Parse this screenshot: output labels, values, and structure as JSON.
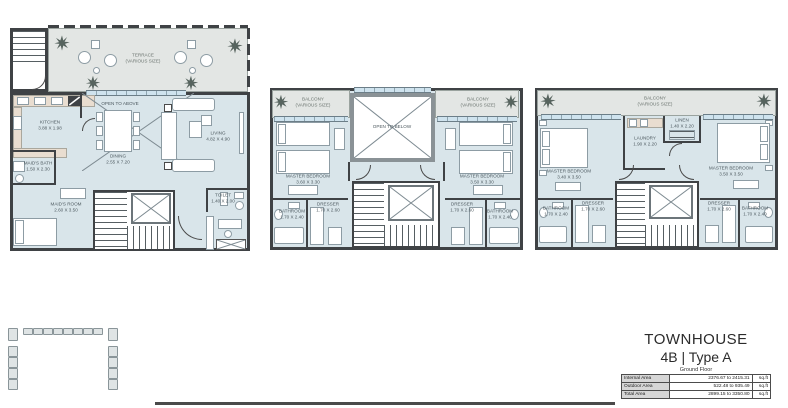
{
  "colors": {
    "wall": "#3f4245",
    "interior_floor": "#d9e5ea",
    "outdoor_floor": "#e3e6e4",
    "counter_beige": "#e9ddd0",
    "furniture_outline": "#8d9ca4",
    "plant": "#57645f",
    "glazing": "#cfe3ee",
    "line": "#4a4a4a"
  },
  "plans": {
    "ground": {
      "labels": {
        "terrace": {
          "name": "TERRACE",
          "size": "(VARIOUS SIZE)"
        },
        "kitchen": {
          "name": "KITCHEN",
          "dims": "3.88 X 1.98"
        },
        "open_above": {
          "name": "OPEN TO ABOVE"
        },
        "dining": {
          "name": "DINING",
          "dims": "2.55 X 7.20"
        },
        "living": {
          "name": "LIVING",
          "dims": "4.82 X 4.90"
        },
        "maids_bath": {
          "name": "MAID'S BATH",
          "dims": "1.50 X 2.30"
        },
        "maids_room": {
          "name": "MAID'S ROOM",
          "dims": "2.60 X 3.50"
        },
        "toilet": {
          "name": "TOILET",
          "dims": "1.40 X 2.00"
        }
      }
    },
    "first": {
      "labels": {
        "balcony_left": {
          "name": "BALCONY",
          "size": "(VARIOUS SIZE)"
        },
        "balcony_right": {
          "name": "BALCONY",
          "size": "(VARIOUS SIZE)"
        },
        "open_below": {
          "name": "OPEN TO BELOW"
        },
        "master_left": {
          "name": "MASTER BEDROOM",
          "dims": "3.60 X 3.30"
        },
        "master_right": {
          "name": "MASTER BEDROOM",
          "dims": "3.50 X 3.30"
        },
        "bathroom_left": {
          "name": "BATHROOM",
          "dims": "1.70 X 2.40"
        },
        "dresser_left": {
          "name": "DRESSER",
          "dims": "1.70 X 2.60"
        },
        "dresser_right": {
          "name": "DRESSER",
          "dims": "1.70 X 2.60"
        },
        "bathroom_right": {
          "name": "BATHROOM",
          "dims": "1.70 X 2.40"
        }
      }
    },
    "second": {
      "labels": {
        "balcony": {
          "name": "BALCONY",
          "size": "(VARIOUS SIZE)"
        },
        "master_left": {
          "name": "MASTER BEDROOM",
          "dims": "3.40 X 3.50"
        },
        "laundry": {
          "name": "LAUNDRY",
          "dims": "1.90 X 2.20"
        },
        "linen": {
          "name": "LINEN",
          "dims": "1.40 X 2.20"
        },
        "master_right": {
          "name": "MASTER BEDROOM",
          "dims": "3.50 X 3.50"
        },
        "bathroom_left": {
          "name": "BATHROOM",
          "dims": "1.70 X 2.40"
        },
        "dresser_left": {
          "name": "DRESSER",
          "dims": "1.70 X 2.60"
        },
        "dresser_right": {
          "name": "DRESSER",
          "dims": "1.70 X 2.60"
        },
        "bathroom_right": {
          "name": "BATHROOM",
          "dims": "1.70 X 2.40"
        }
      }
    }
  },
  "title_block": {
    "title": "TOWNHOUSE",
    "subtitle": "4B | Type A",
    "floor": "Ground Floor",
    "area_table": [
      {
        "label": "Internal Area",
        "value": "2376.67 to 2415.31",
        "unit": "sq.ft"
      },
      {
        "label": "Outdoor Area",
        "value": "522.48 to 935.49",
        "unit": "sq.ft"
      },
      {
        "label": "Total Area",
        "value": "2899.15 to 3350.80",
        "unit": "sq.ft"
      }
    ]
  }
}
